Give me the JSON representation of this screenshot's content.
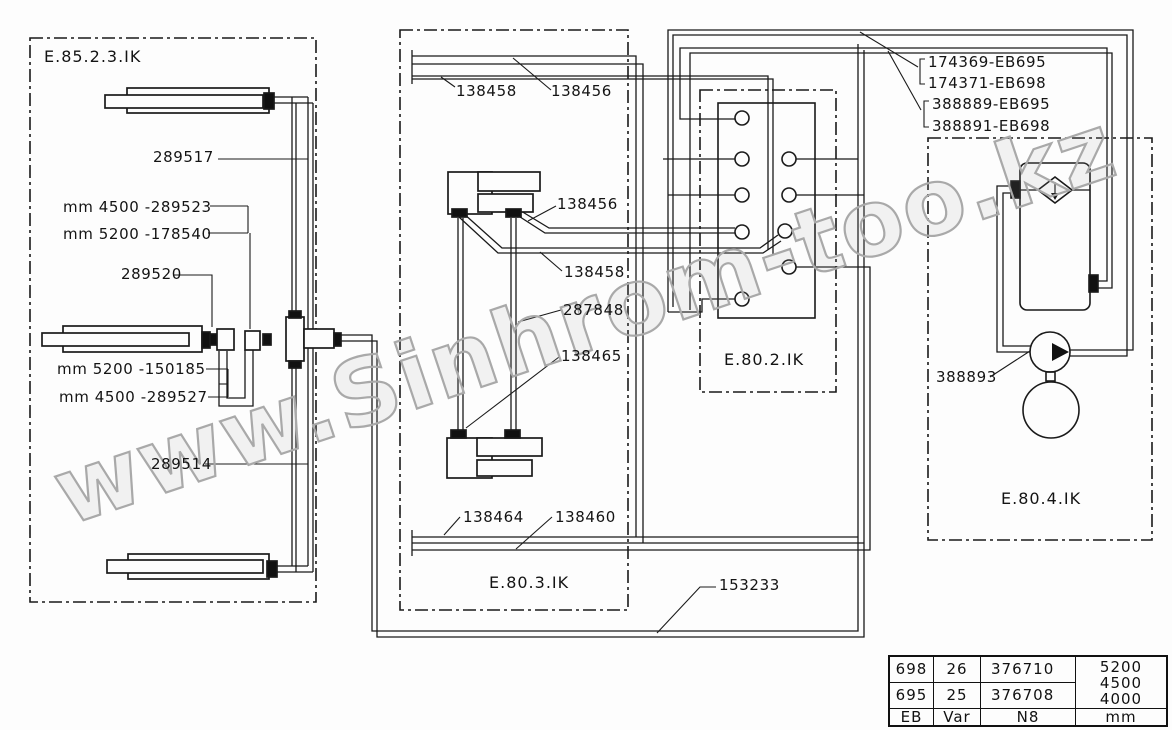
{
  "watermark": {
    "text": "www.Sinhrom-too.kz",
    "color": "#a9a9a9"
  },
  "panels": {
    "left": {
      "label": "E.85.2.3.IK"
    },
    "middle": {
      "label": "E.80.3.IK"
    },
    "valves": {
      "label": "E.80.2.IK"
    },
    "right": {
      "label": "E.80.4.IK"
    }
  },
  "part_labels": {
    "p289517": "289517",
    "p289523": "mm 4500 -289523",
    "p178540": "mm 5200 -178540",
    "p289520": "289520",
    "p150185": "mm 5200 -150185",
    "p289527": "mm 4500 -289527",
    "p289514": "289514",
    "p138458_top": "138458",
    "p138456_top": "138456",
    "p138456_mid": "138456",
    "p138458_mid": "138458",
    "p287848": "287848",
    "p138465": "138465",
    "p138464": "138464",
    "p138460": "138460",
    "p153233": "153233",
    "p388893": "388893",
    "p174369": "174369-EB695",
    "p174371": "174371-EB698",
    "p388889": "388889-EB695",
    "p388891": "388891-EB698"
  },
  "table": {
    "rows": [
      [
        "698",
        "26",
        "376710"
      ],
      [
        "695",
        "25",
        "376708"
      ]
    ],
    "merged_col": [
      "5200",
      "4500",
      "4000"
    ],
    "footer": [
      "EB",
      "Var",
      "N8",
      "mm"
    ]
  },
  "colors": {
    "line": "#1a1a1a",
    "background": "#fdfdfd",
    "watermark": "#a9a9a9"
  }
}
